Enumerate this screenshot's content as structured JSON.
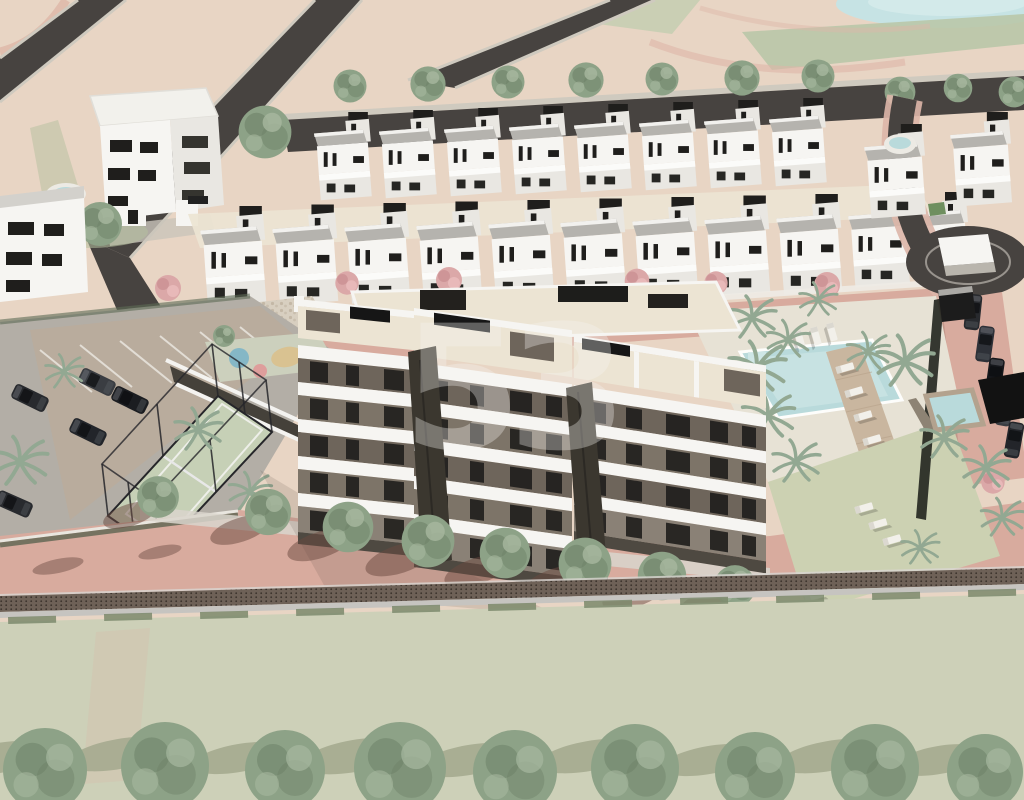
{
  "meta": {
    "description": "Aerial 3D architectural rendering of a residential development: a central five-storey apartment block with rooftop terraces, rows of white townhouses, communal pools with sun loungers, padel court, surface parking, landscaped grounds and a perimeter wall along a street with a green field and tree row in the foreground.",
    "style": "daylight CGI render, no UI text visible"
  },
  "watermark": {
    "text": "53",
    "color": "#ffffff",
    "opacity": "0.33"
  },
  "palette": {
    "beige": "#e8d5c4",
    "beigeLight": "#eedfd0",
    "roadDark": "#474340",
    "roadEdge": "#cfcabf",
    "pinkPath": "#ddb6a8",
    "pinkRoad": "#cfa092",
    "pinkRoadLight": "#d8ab9e",
    "roadShadow": "#6b4a40",
    "field": "#cdd0b8",
    "wall": "#6e6157",
    "wallRail": "#c6c4c0",
    "white": "#f6f5f2",
    "offWhite": "#e9e7e2",
    "grayLight": "#d3d1cc",
    "grayRoof": "#b5b3ae",
    "darkWall": "#6e655b",
    "window": "#1f1e1c",
    "black": "#161616",
    "cream": "#ece4d3",
    "treeGreen": "#8da287",
    "treeDark": "#6e8168",
    "treeLight": "#a7b89f",
    "palm": "#92a892",
    "pinkTree": "#dba8a8",
    "pool": "#b9dadb",
    "poolLight": "#d3e9e8",
    "deckWood": "#c9b69f",
    "lawn": "#ccd1b2",
    "court": "#c6d0b6",
    "carDark": "#282a2e",
    "pgBlue": "#85b7c6",
    "pgPink": "#de9e9c",
    "pgSand": "#d9c291",
    "grass": "#b4bf9e"
  },
  "scene": {
    "elements": [
      "top-left three-storey apartment building",
      "left-edge apartment building with small pool",
      "back row of eight white townhouses",
      "front row of eleven white townhouses",
      "central five-storey apartment building with cream rooftop terraces and black pergolas",
      "communal swimming pool with wooden deck and sun loungers",
      "secondary plunge pool with stone surround",
      "black pool pergola",
      "palm trees",
      "pink flowering trees",
      "padel court with black fence",
      "surface parking with five cars",
      "children playground with coloured circles",
      "garage entrance ramp",
      "roundabout with white utility cabin",
      "access road with parked cars",
      "street trees casting shadows",
      "perimeter wall with railing",
      "green field",
      "row of nine trees at the bottom",
      "pond at top right"
    ]
  }
}
